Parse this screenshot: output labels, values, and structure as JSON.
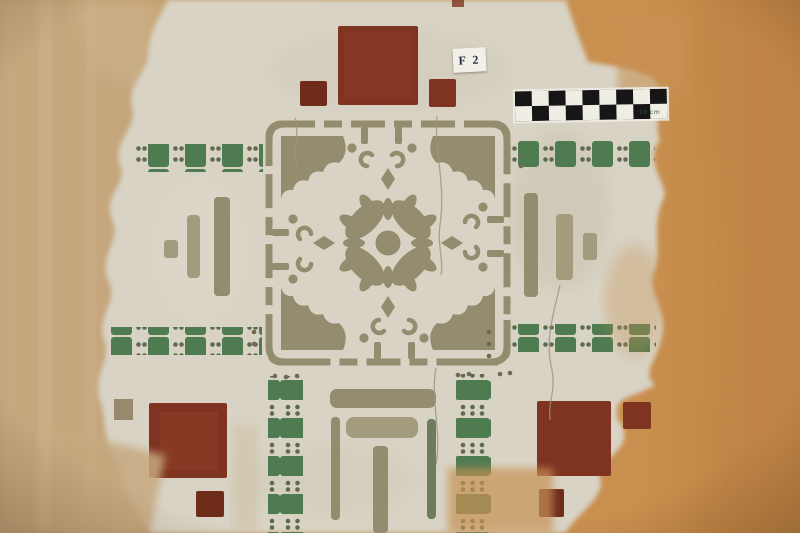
{
  "labels": {
    "find_number": "F 2",
    "scale": "10 cm"
  },
  "scale_bar": {
    "rows": 2,
    "columns": 9
  },
  "palette": {
    "wall": "#c79255",
    "wall_light": "#c6a87f",
    "wall_dark": "#ad7c40",
    "plaster": "#d8d3c4",
    "plaster_dark": "#c7c1ae",
    "olive": "#948c6e",
    "olive_light": "#a39b7d",
    "olive_dark": "#6f6a52",
    "green": "#4e7b50",
    "green_dot": "#5d6b4c",
    "red": "#7f3422",
    "red_dark": "#6f2c1b",
    "scale_black": "#161616",
    "scale_white": "#f0ede4",
    "label_ink": "#252c4e"
  }
}
